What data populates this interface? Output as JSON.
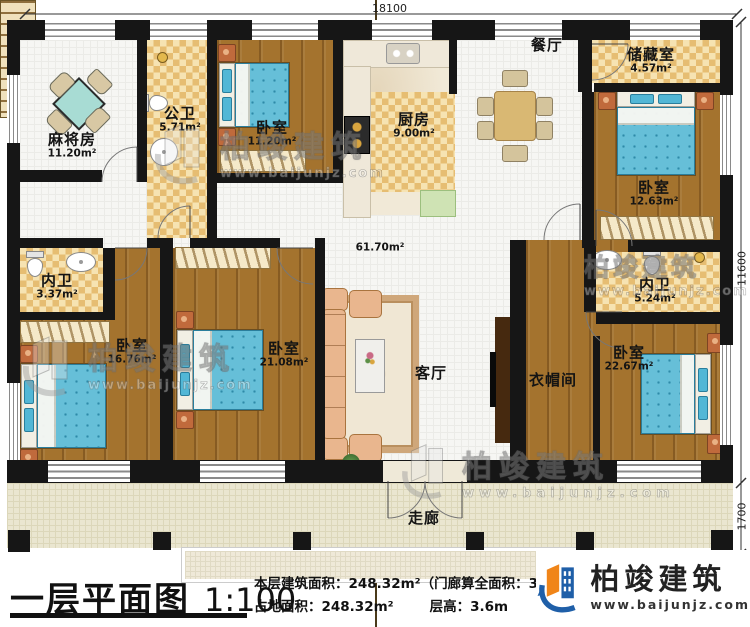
{
  "dimensions": {
    "total_width": "18100",
    "main_depth": "11600",
    "porch_depth": "1700"
  },
  "rooms": {
    "mahjong": {
      "name": "麻将房",
      "area": "11.20m²"
    },
    "public_bath": {
      "name": "公卫",
      "area": "5.71m²"
    },
    "bedroom_top": {
      "name": "卧室",
      "area": "11.20m²"
    },
    "kitchen": {
      "name": "厨房",
      "area": "9.00m²"
    },
    "dining": {
      "name": "餐厅"
    },
    "storage": {
      "name": "储藏室",
      "area": "4.57m²"
    },
    "bedroom_right_top": {
      "name": "卧室",
      "area": "12.63m²"
    },
    "inner_bath_left": {
      "name": "内卫",
      "area": "3.37m²"
    },
    "bedroom_left": {
      "name": "卧室",
      "area": "16.76m²"
    },
    "bedroom_mid": {
      "name": "卧室",
      "area": "21.08m²"
    },
    "living": {
      "name": "客厅",
      "area": "61.70m²"
    },
    "inner_bath_right": {
      "name": "内卫",
      "area": "5.24m²"
    },
    "cloakroom": {
      "name": "衣帽间"
    },
    "bedroom_right_bottom": {
      "name": "卧室",
      "area": "22.67m²"
    },
    "corridor": {
      "name": "走廊"
    }
  },
  "footer": {
    "title": "一层平面图",
    "scale": "1:100",
    "line1": "本层建筑面积：248.32m²（门廊算全面积：31.1",
    "line2_left": "占地面积：248.32m²",
    "line2_right": "层高：3.6m"
  },
  "brand": {
    "name": "柏竣建筑",
    "url": "www.baijunjz.com"
  },
  "colors": {
    "wall": "#161616",
    "wood": "#a4732e",
    "tile": "#e6bd72",
    "bed_blue": "#66bfd8",
    "brand_orange": "#f08519",
    "brand_blue": "#1f5fa8"
  }
}
